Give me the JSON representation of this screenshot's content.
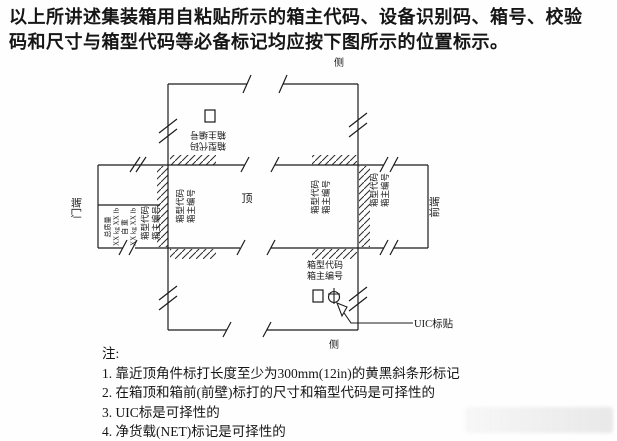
{
  "header": {
    "line1": "以上所讲述集装箱用自粘贴所示的箱主代码、设备识别码、箱号、校验",
    "line2": "码和尺寸与箱型代码等必备标记均应按下图所示的位置标示。"
  },
  "diagram": {
    "labels": {
      "door_end": "门端",
      "front_end": "前端",
      "top": "顶",
      "side_upper": "侧",
      "side_lower": "侧",
      "uic_callout": "UIC标贴"
    },
    "markings": {
      "type_code": "箱型代码",
      "owner_number": "箱主编号",
      "gross_label": "总质量",
      "gross_value": "XX kg XX lb",
      "tare_label": "自 重",
      "tare_value": "XX kg XX lb"
    },
    "colors": {
      "ink": "#1c1c1c",
      "background": "#fefefe"
    }
  },
  "notes": {
    "title": "注:",
    "items": [
      "1. 靠近顶角件标打长度至少为300mm(12in)的黄黑斜条形标记",
      "2. 在箱顶和箱前(前壁)标打的尺寸和箱型代码是可择性的",
      "3. UIC标是可择性的",
      "4. 净货载(NET)标记是可择性的"
    ]
  }
}
